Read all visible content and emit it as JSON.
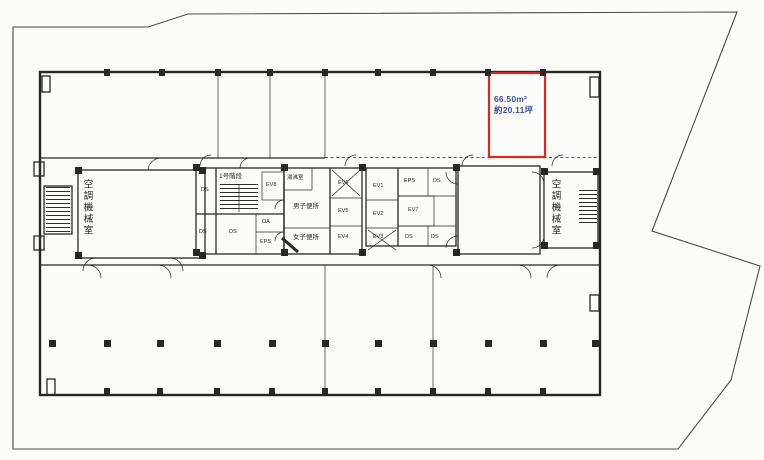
{
  "highlight": {
    "area_sqm": "66.50m²",
    "area_tsubo": "約20.11坪"
  },
  "rooms": {
    "left_machine_room": "空調機械室",
    "right_machine_room": "空調機械室",
    "stair1": "1号階段",
    "kitchenette": "湯沸室",
    "mens_toilet": "男子便所",
    "womens_toilet": "女子便所",
    "ds": "DS",
    "eps": "EPS",
    "oa": "OA",
    "ev1": "EV1",
    "ev2": "EV2",
    "ev3": "EV3",
    "ev4": "EV4",
    "ev5": "EV5",
    "ev6": "EV6",
    "ev7": "EV7",
    "ev8": "EV8"
  },
  "colors": {
    "red": "#d42a20",
    "blue": "#3c4f9f",
    "ink": "#272727",
    "boundary": "#4a4a4a",
    "paper": "#fcfcfa"
  }
}
